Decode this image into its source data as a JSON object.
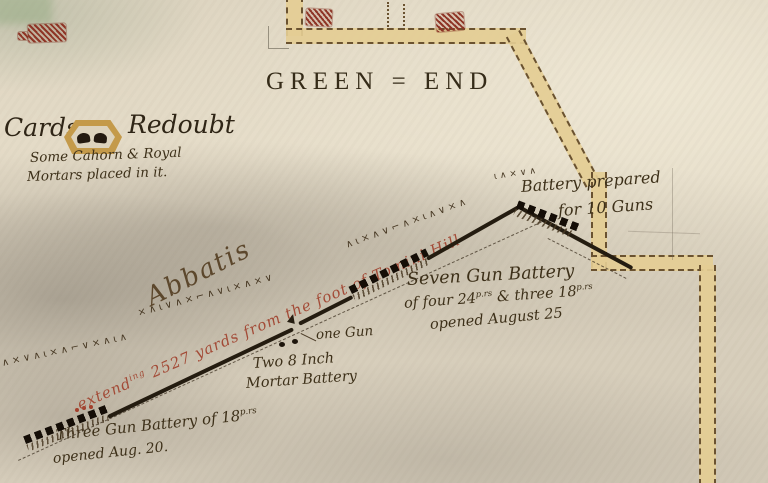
{
  "palette": {
    "paper": "#e2d9c5",
    "ink": "#32281a",
    "red_ink": "#a34b37",
    "road_fill": "#e4cd94",
    "road_edge": "#6a5230",
    "fort_gold": "#c49a4a",
    "building_red": "#8e3526"
  },
  "map": {
    "region_title": "GREEN = END",
    "cards_redoubt": {
      "name_left": "Cards",
      "name_right": "Redoubt",
      "note_line1": "Some Cahorn & Royal",
      "note_line2": "Mortars placed in it."
    },
    "battery_prepared": {
      "line1": "Battery prepared",
      "line2": "for 10 Guns"
    },
    "seven_gun_battery": {
      "line1": "Seven Gun Battery",
      "line2_a": "of four 24",
      "line2_sup_a": "p.rs",
      "line2_b": " & three 18",
      "line2_sup_b": "p.rs",
      "line3": "opened August 25"
    },
    "one_gun_label": "one Gun",
    "mortar_battery": {
      "line1": "Two 8 Inch",
      "line2": "Mortar Battery"
    },
    "three_gun_battery": {
      "line1": "Three Gun Battery of 18",
      "line1_sup": "p.rs",
      "line2": "opened Aug. 20."
    },
    "abbatis_label": "Abbatis",
    "red_annotation": {
      "word": "extend",
      "sup": "ing",
      "rest": " 2527 yards from the foot of Tomini Hill"
    },
    "zigzag_rows": {
      "left_tail": "∧×∨∧ι×∧⌐∨×∧ι∧",
      "mid": "×∧ι∨∧×⌐∧∨ι×∧×∨",
      "upper": "∧ι×∧∨⌐∧×ι∧∨×∧",
      "tip": "ι∧×∨∧"
    }
  }
}
